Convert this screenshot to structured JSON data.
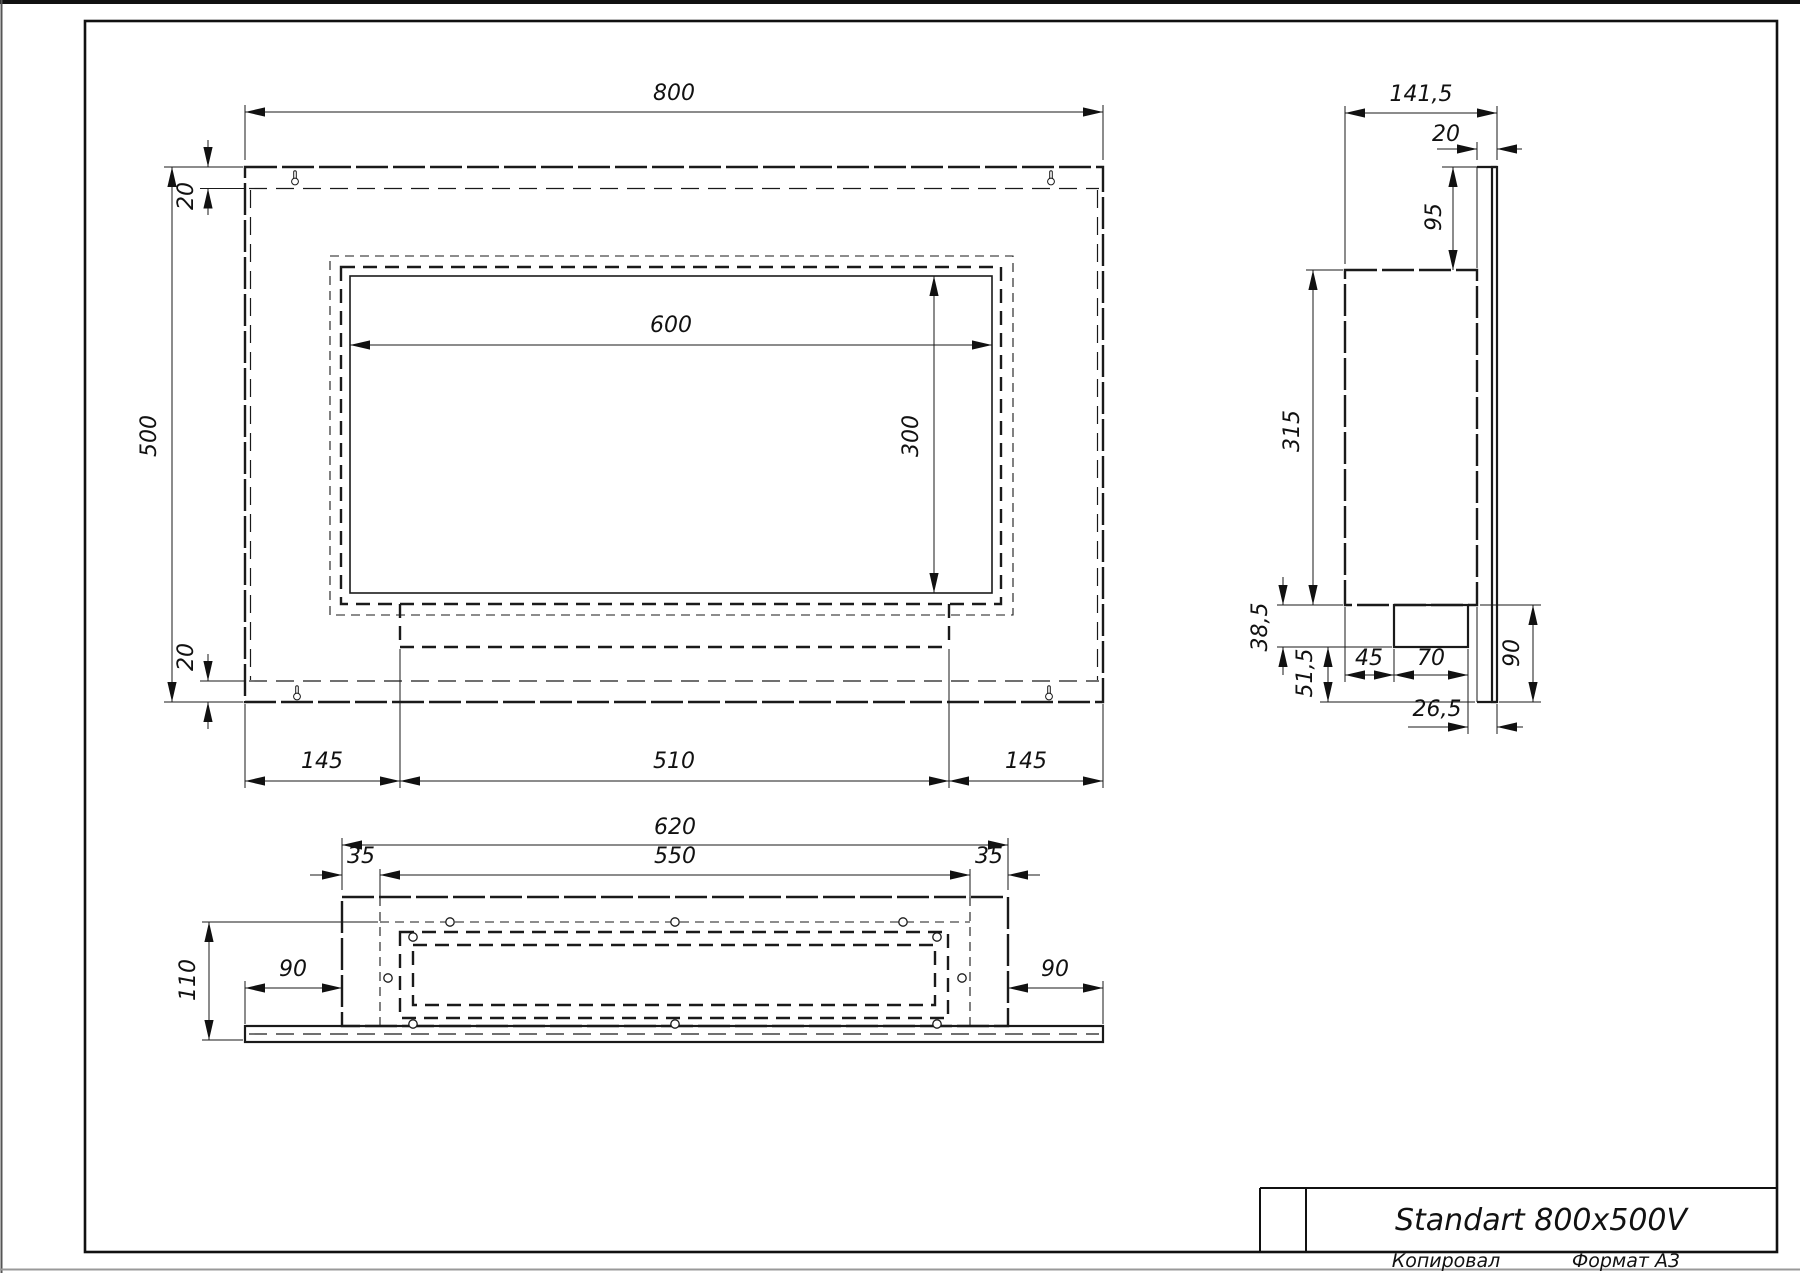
{
  "title_block": {
    "title": "Standart 800x500V"
  },
  "footer": {
    "left": "Копировал",
    "right": "Формат А3"
  },
  "front_view": {
    "dims": {
      "width": "800",
      "height": "500",
      "flange_top": "20",
      "flange_bottom": "20",
      "opening_width": "600",
      "opening_height": "300",
      "margin_left": "145",
      "tray_width": "510",
      "margin_right": "145"
    }
  },
  "side_view": {
    "dims": {
      "depth": "141,5",
      "flange_depth": "20",
      "top_offset": "95",
      "box_height": "315",
      "tray_drop": "38,5",
      "bottom_gap": "51,5",
      "tray_offset": "45",
      "tray_depth": "70",
      "bottom_height": "90",
      "tray_to_front": "26,5"
    }
  },
  "bottom_view": {
    "dims": {
      "box_width": "620",
      "inner_width": "550",
      "inset_left": "35",
      "inset_right": "35",
      "depth": "110",
      "overhang_left": "90",
      "overhang_right": "90"
    }
  }
}
